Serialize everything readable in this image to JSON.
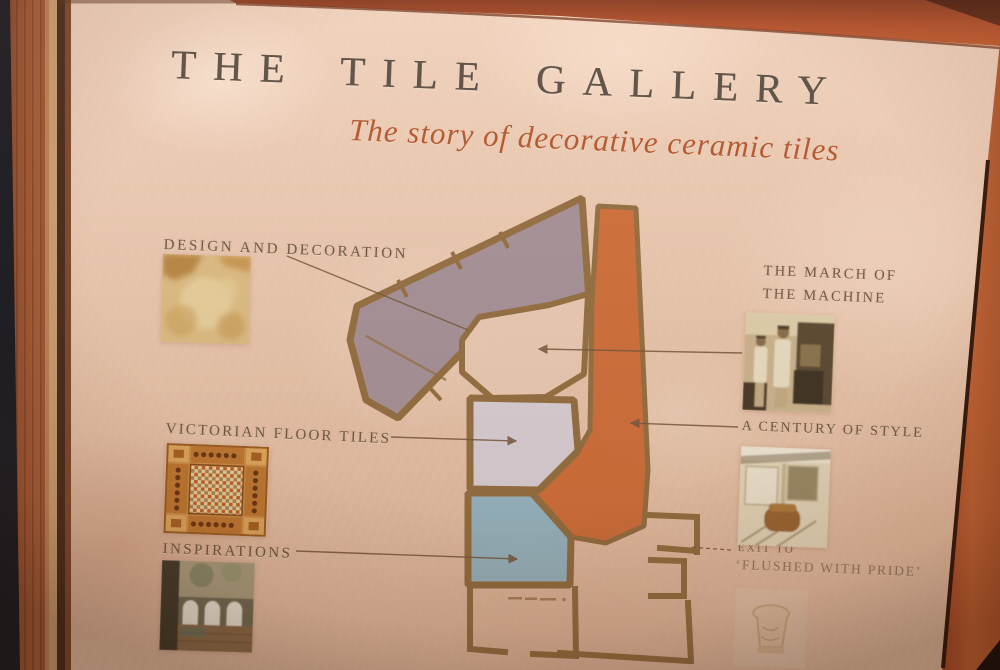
{
  "sign": {
    "title": "THE TILE GALLERY",
    "subtitle": "The story of decorative ceramic tiles"
  },
  "plan_labels": {
    "design": "DESIGN AND DECORATION",
    "victorian": "VICTORIAN FLOOR TILES",
    "inspirations": "INSPIRATIONS",
    "march_line1": "THE MARCH OF",
    "march_line2": "THE MACHINE",
    "century": "A CENTURY OF STYLE",
    "exit_line1": "EXIT TO",
    "exit_line2": "‘FLUSHED WITH PRIDE’"
  },
  "floor_plan": {
    "wall_color": "#8f6a3a",
    "open_color": "#edcdb6",
    "pointer_line_color": "#6e4f33",
    "rooms": [
      {
        "name": "design-and-decoration-gallery",
        "color": "#a29098"
      },
      {
        "name": "machine-corridor",
        "color": "#cf6a33"
      },
      {
        "name": "victorian-floor-tiles-room",
        "color": "#dad2da"
      },
      {
        "name": "inspirations-room",
        "color": "#93b7c6"
      }
    ]
  },
  "photo_frame": {
    "left_wood": "#8e4a2c",
    "top_wood": "#b5502a",
    "right_wood": "#c06030",
    "panel_background": "#ebc7af",
    "title_color": "#5a4e43",
    "subtitle_color": "#b4562d",
    "label_color": "#685038"
  }
}
